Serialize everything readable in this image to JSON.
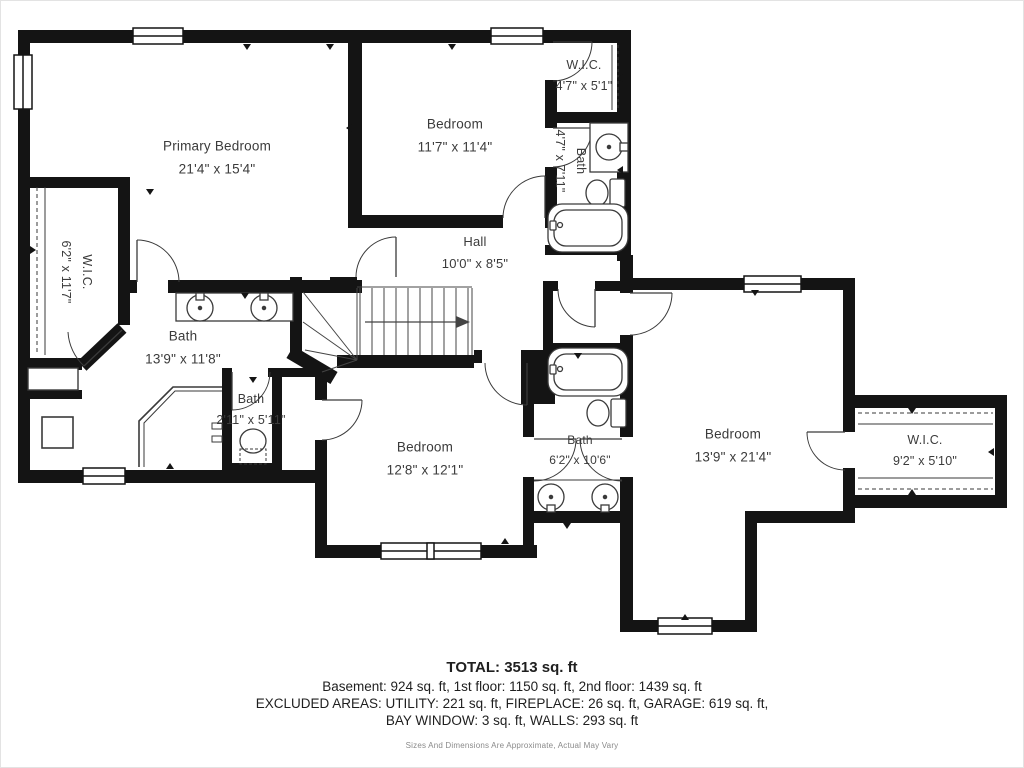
{
  "floorplan": {
    "rooms": [
      {
        "name": "Primary Bedroom",
        "dims": "21'4\" x 15'4\"",
        "x": 217,
        "y": 158,
        "rotate": 0,
        "size": 13.5
      },
      {
        "name": "Bedroom",
        "dims": "11'7\" x 11'4\"",
        "x": 455,
        "y": 136,
        "rotate": 0,
        "size": 13.5
      },
      {
        "name": "W.I.C.",
        "dims": "4'7\" x 5'1\"",
        "x": 584,
        "y": 76,
        "rotate": 0,
        "size": 12.5
      },
      {
        "name": "Bath",
        "dims": "4'7\" x 7'11\"",
        "x": 570,
        "y": 161,
        "rotate": 90,
        "size": 12.5
      },
      {
        "name": "Hall",
        "dims": "10'0\" x 8'5\"",
        "x": 475,
        "y": 253,
        "rotate": 0,
        "size": 13
      },
      {
        "name": "W.I.C.",
        "dims": "6'2\" x 11'7\"",
        "x": 76,
        "y": 272,
        "rotate": 90,
        "size": 12.5
      },
      {
        "name": "Bath",
        "dims": "13'9\" x 11'8\"",
        "x": 183,
        "y": 348,
        "rotate": 0,
        "size": 13.5
      },
      {
        "name": "Bath",
        "dims": "2'11\" x 5'11\"",
        "x": 251,
        "y": 410,
        "rotate": 0,
        "size": 12.5
      },
      {
        "name": "Bedroom",
        "dims": "12'8\" x 12'1\"",
        "x": 425,
        "y": 459,
        "rotate": 0,
        "size": 13.5
      },
      {
        "name": "Bath",
        "dims": "6'2\" x 10'6\"",
        "x": 580,
        "y": 450,
        "rotate": 0,
        "size": 12
      },
      {
        "name": "Bedroom",
        "dims": "13'9\" x 21'4\"",
        "x": 733,
        "y": 446,
        "rotate": 0,
        "size": 13.5
      },
      {
        "name": "W.I.C.",
        "dims": "9'2\" x 5'10\"",
        "x": 925,
        "y": 451,
        "rotate": 0,
        "size": 12.5
      }
    ],
    "summary": {
      "total": "TOTAL: 3513 sq. ft",
      "floors": "Basement: 924 sq. ft, 1st floor: 1150 sq. ft, 2nd floor: 1439 sq. ft",
      "excluded": "EXCLUDED AREAS: UTILITY: 221 sq. ft, FIREPLACE: 26 sq. ft, GARAGE: 619 sq. ft,",
      "excluded2": "BAY WINDOW: 3 sq. ft, WALLS: 293 sq. ft",
      "disclaimer": "Sizes And Dimensions Are Approximate, Actual May Vary"
    },
    "colors": {
      "wall": "#141414",
      "line": "#333333",
      "text": "#3b3b3b"
    }
  }
}
